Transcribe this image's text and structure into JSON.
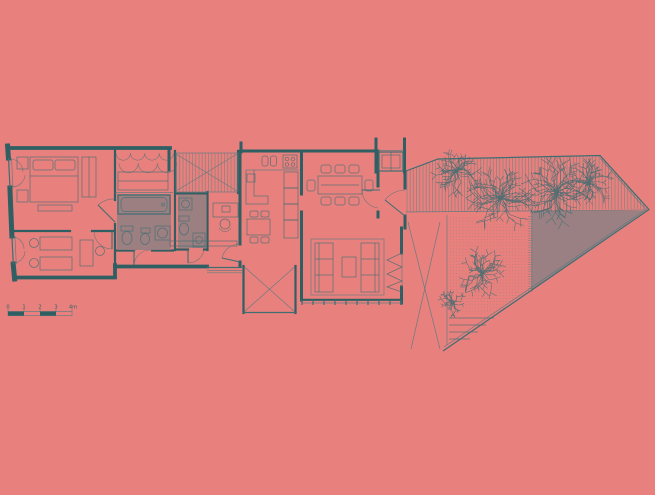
{
  "meta": {
    "type": "architectural-floor-plan",
    "description": "Single-storey apartment plan: two bedrooms, wardrobe wall, two bathrooms, study, kitchen, dining and living rooms, interior patios, opening onto a triangular planted garden terrace with timber deck"
  },
  "colors": {
    "background": "#e8817e",
    "wall_ink": "#305f63",
    "line_mid": "#3f6d72",
    "line_light": "#54797e",
    "wet_room_floor": "#957f80",
    "terrace_paving": "#9a8083",
    "tree_ink": "#3c6b70"
  },
  "scale_bar": {
    "labels": [
      "0",
      "1",
      "2",
      "3",
      "4m"
    ]
  },
  "trees": [
    {
      "cx": 456,
      "cy": 171,
      "r": 22
    },
    {
      "cx": 501,
      "cy": 198,
      "r": 29
    },
    {
      "cx": 556,
      "cy": 192,
      "r": 30
    },
    {
      "cx": 589,
      "cy": 183,
      "r": 21
    },
    {
      "cx": 482,
      "cy": 273,
      "r": 22
    },
    {
      "cx": 453,
      "cy": 303,
      "r": 13
    }
  ]
}
